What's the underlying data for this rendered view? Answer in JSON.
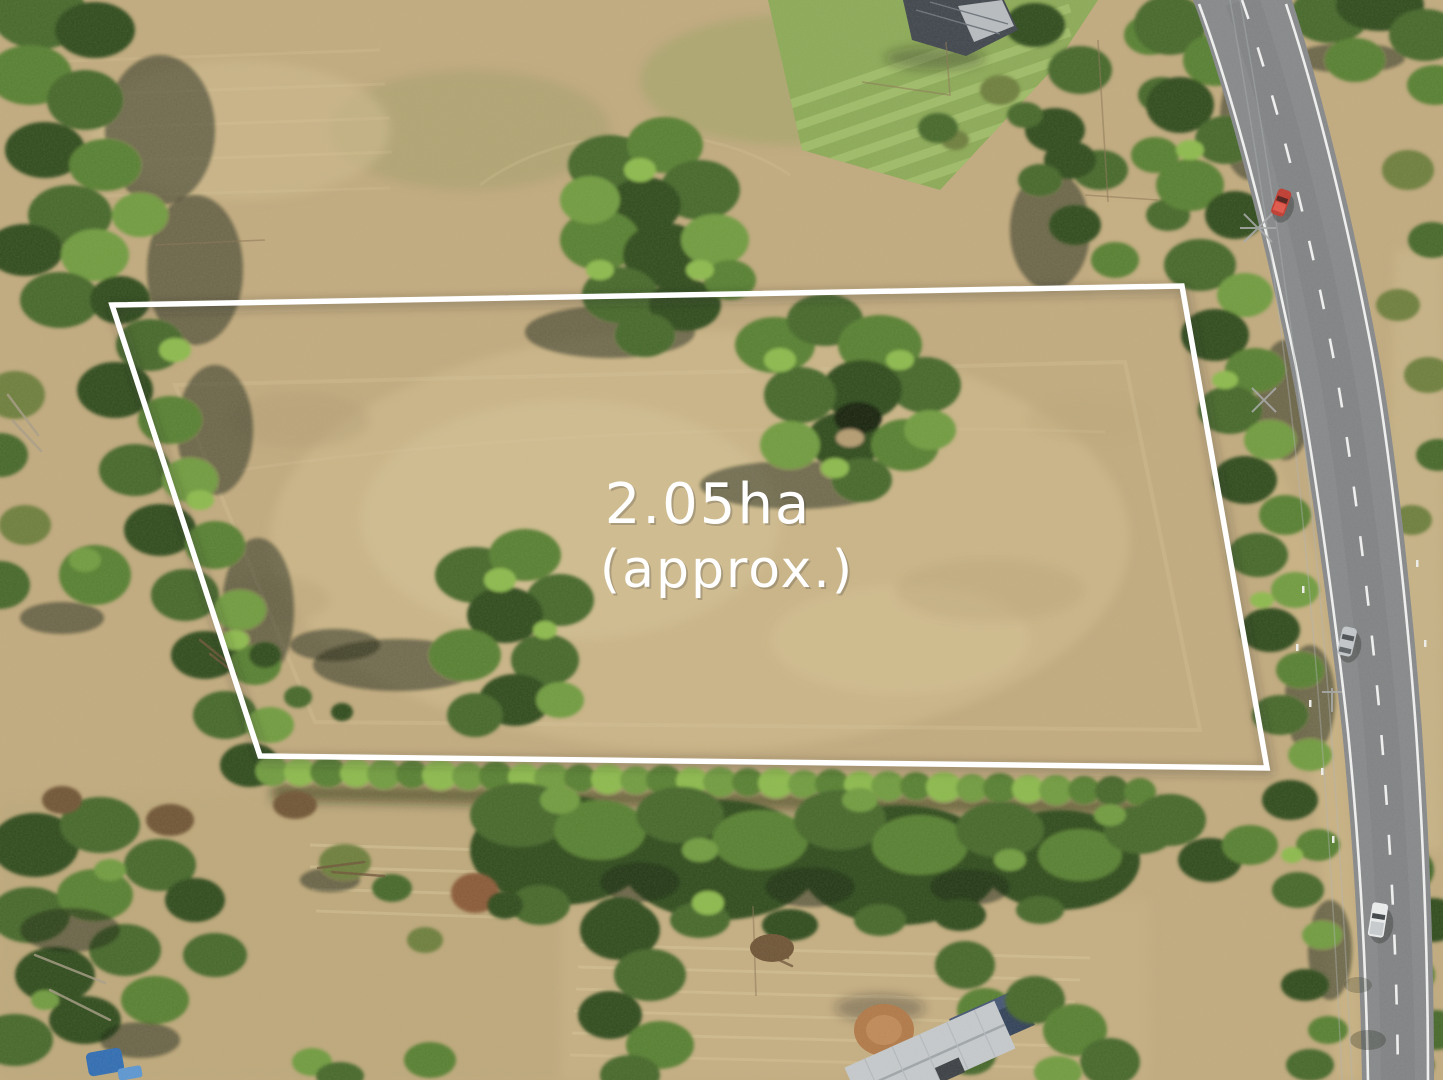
{
  "photo": {
    "area_label": {
      "line1": "2.05ha",
      "line2": "(approx.)"
    },
    "boundary_color": "#ffffff",
    "label_color": "#ffffff"
  }
}
